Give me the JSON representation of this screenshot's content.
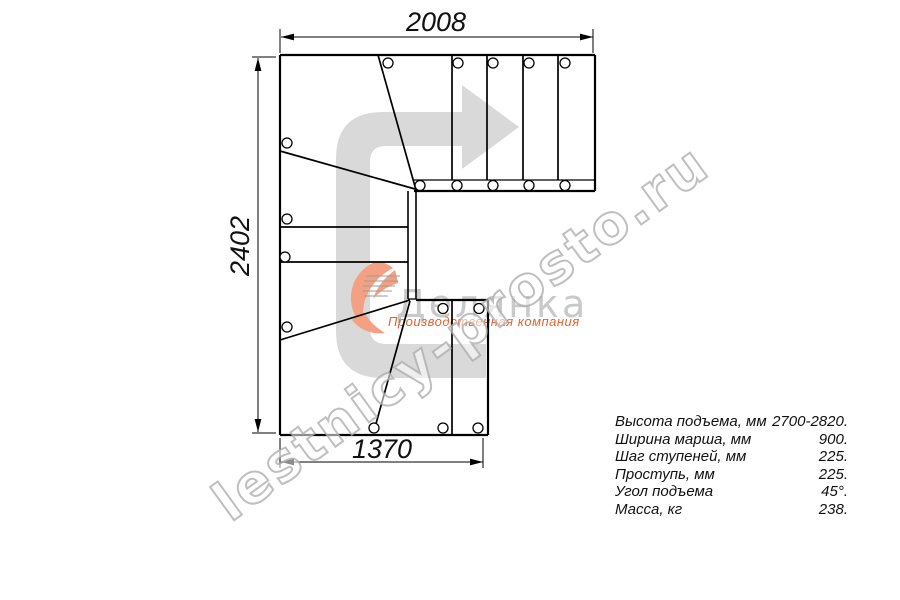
{
  "dimensions": {
    "top_width_mm": "2008",
    "left_height_mm": "2402",
    "bottom_width_mm": "1370"
  },
  "specs": {
    "rows": [
      {
        "label": "Высота подъема, мм",
        "value": "2700-2820."
      },
      {
        "label": "Ширина марша, мм",
        "value": "900."
      },
      {
        "label": "Шаг ступеней, мм",
        "value": "225."
      },
      {
        "label": "Проступь, мм",
        "value": "225."
      },
      {
        "label": "Угол подъема",
        "value": "45°."
      },
      {
        "label": "Масса, кг",
        "value": "238."
      }
    ]
  },
  "watermark": {
    "text": "lestnicy-prosto.ru"
  },
  "logo": {
    "name": "Делянка",
    "caption": "Производственная компания"
  },
  "colors": {
    "line": "#000000",
    "arrow": "#d9d9d9",
    "logo_gray": "#c9c9c9",
    "logo_orange": "#e8632c",
    "swoosh": "#f4a183"
  }
}
